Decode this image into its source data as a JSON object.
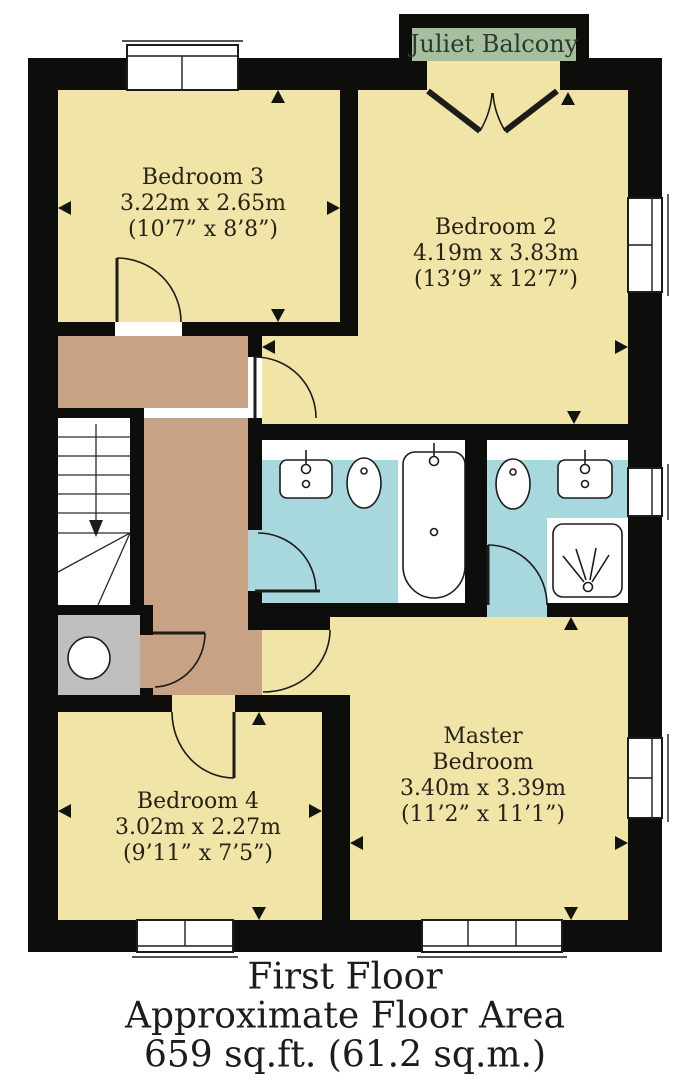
{
  "floorplan": {
    "balcony_label": "Juliet Balcony",
    "rooms": {
      "bedroom3": {
        "name": "Bedroom 3",
        "metric": "3.22m x 2.65m",
        "imperial": "(10’7” x 8’8”)"
      },
      "bedroom2": {
        "name": "Bedroom 2",
        "metric": "4.19m x 3.83m",
        "imperial": "(13’9” x 12’7”)"
      },
      "bedroom4": {
        "name": "Bedroom 4",
        "metric": "3.02m x 2.27m",
        "imperial": "(9’11” x 7’5”)"
      },
      "master": {
        "name_line1": "Master",
        "name_line2": "Bedroom",
        "metric": "3.40m x 3.39m",
        "imperial": "(11’2” x 11’1”)"
      }
    },
    "caption": {
      "line1": "First Floor",
      "line2": "Approximate Floor Area",
      "line3": "659 sq.ft. (61.2 sq.m.)"
    },
    "icons": {
      "bath": "bathtub-icon",
      "shower": "shower-icon",
      "toilet": "toilet-icon",
      "sink": "sink-icon",
      "tank": "water-tank-icon",
      "stairs": "stairs-down-arrow-icon"
    },
    "colors": {
      "room_fill": "#f0e5a6",
      "bathroom_fill": "#a7d8dd",
      "hallway_fill": "#c8a284",
      "closet_fill": "#bfbfbf",
      "balcony_fill": "#a6bf9f",
      "wall": "#0d0d0c",
      "line": "#1c1c1a",
      "text": "#262219"
    }
  }
}
